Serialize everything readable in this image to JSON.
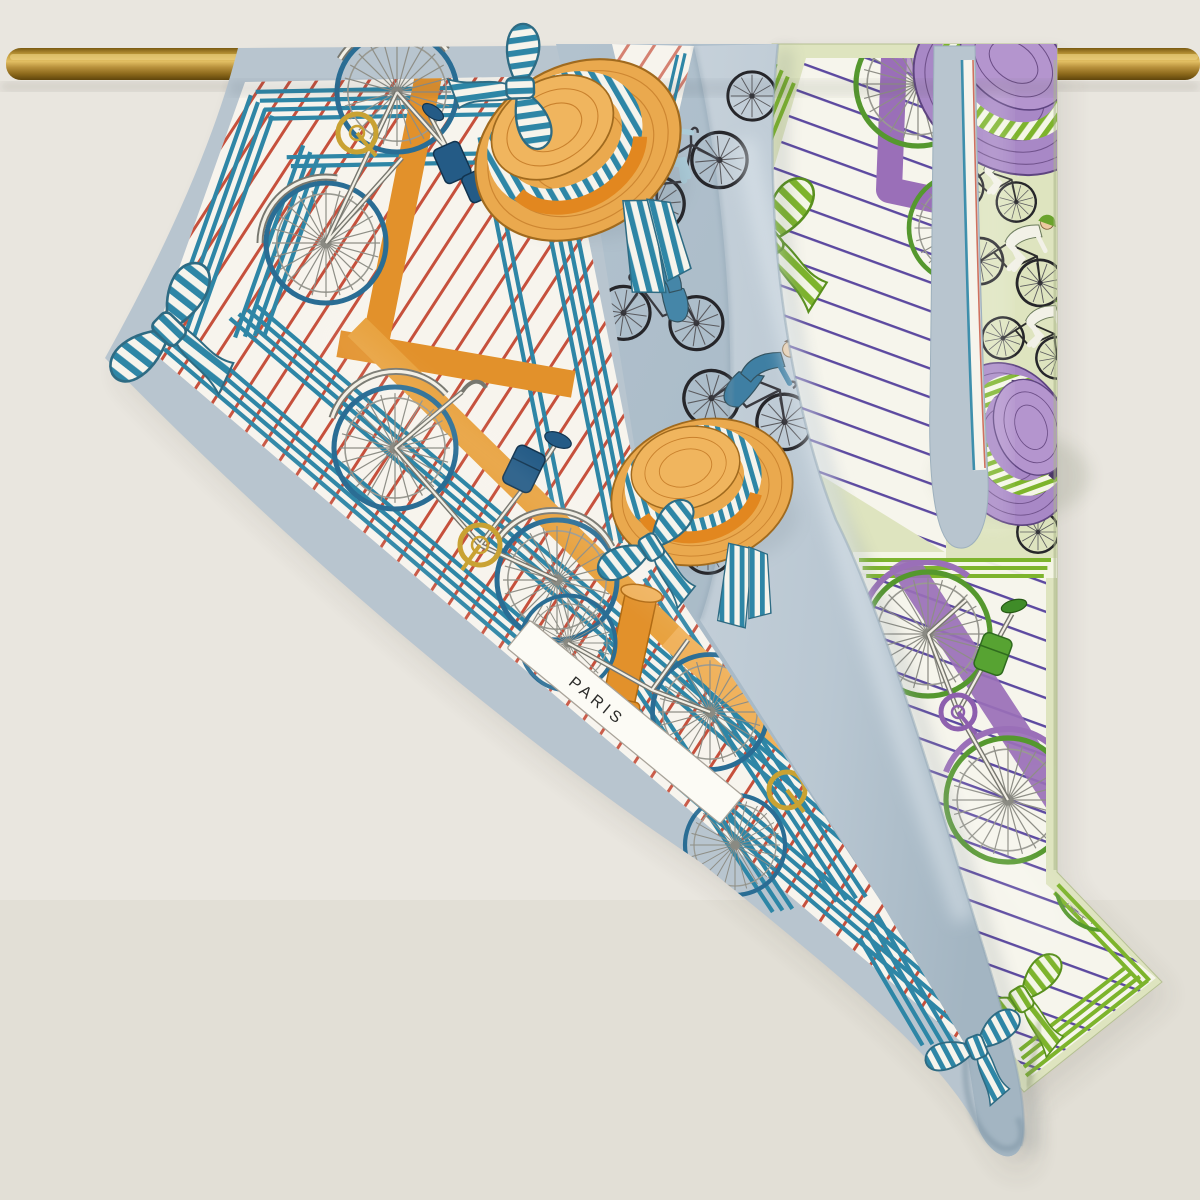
{
  "scene": {
    "kind": "product-photograph",
    "subject": "Two printed silk twill scarves with vintage bicycle motif draped over a brass rail",
    "background_color": "#e9e6df",
    "wall_shadow": "#6b655a",
    "rod": {
      "name": "brass-rail",
      "base": "#a87c22",
      "highlight": "#f0d98c",
      "dark": "#6b4f10"
    },
    "labels": {
      "paris": "PARIS"
    },
    "left_scarf": {
      "name": "blue-orange bicycle scarf",
      "border": "#b8c5cf",
      "fold": "#bcc9d3",
      "panel": "#a9bcc9",
      "ground": "#f7f4ed",
      "pinstripe": "#c6503c",
      "frame_stripe": "#2e86a6",
      "accent": "#e2912b",
      "accent_light": "#f0b25c",
      "accent_dark": "#b06a12",
      "rim": "#2a6d94",
      "gold": "#c9a233",
      "navy": "#245b86",
      "hat_straw": "#eaa94e",
      "hat_straw_line": "#c9812d",
      "motifs": [
        "safety bicycles",
        "straw boater hats",
        "striped bows",
        "cyclists",
        "PARIS sign"
      ]
    },
    "right_scarf": {
      "name": "pistachio-purple bicycle scarf",
      "ground": "#dee4bf",
      "white": "#f6f5ec",
      "pinstripe": "#5c49a0",
      "stripe": "#7db42c",
      "purple": "#9a6fb8",
      "purple_dark": "#4a3766",
      "rim": "#55982e",
      "hat_purple": "#a888c6",
      "hat_purple_line": "#6b4d86",
      "saddle_green": "#3f8c28",
      "motifs": [
        "safety bicycles",
        "purple boater hats",
        "green striped bows",
        "cyclists"
      ]
    }
  }
}
